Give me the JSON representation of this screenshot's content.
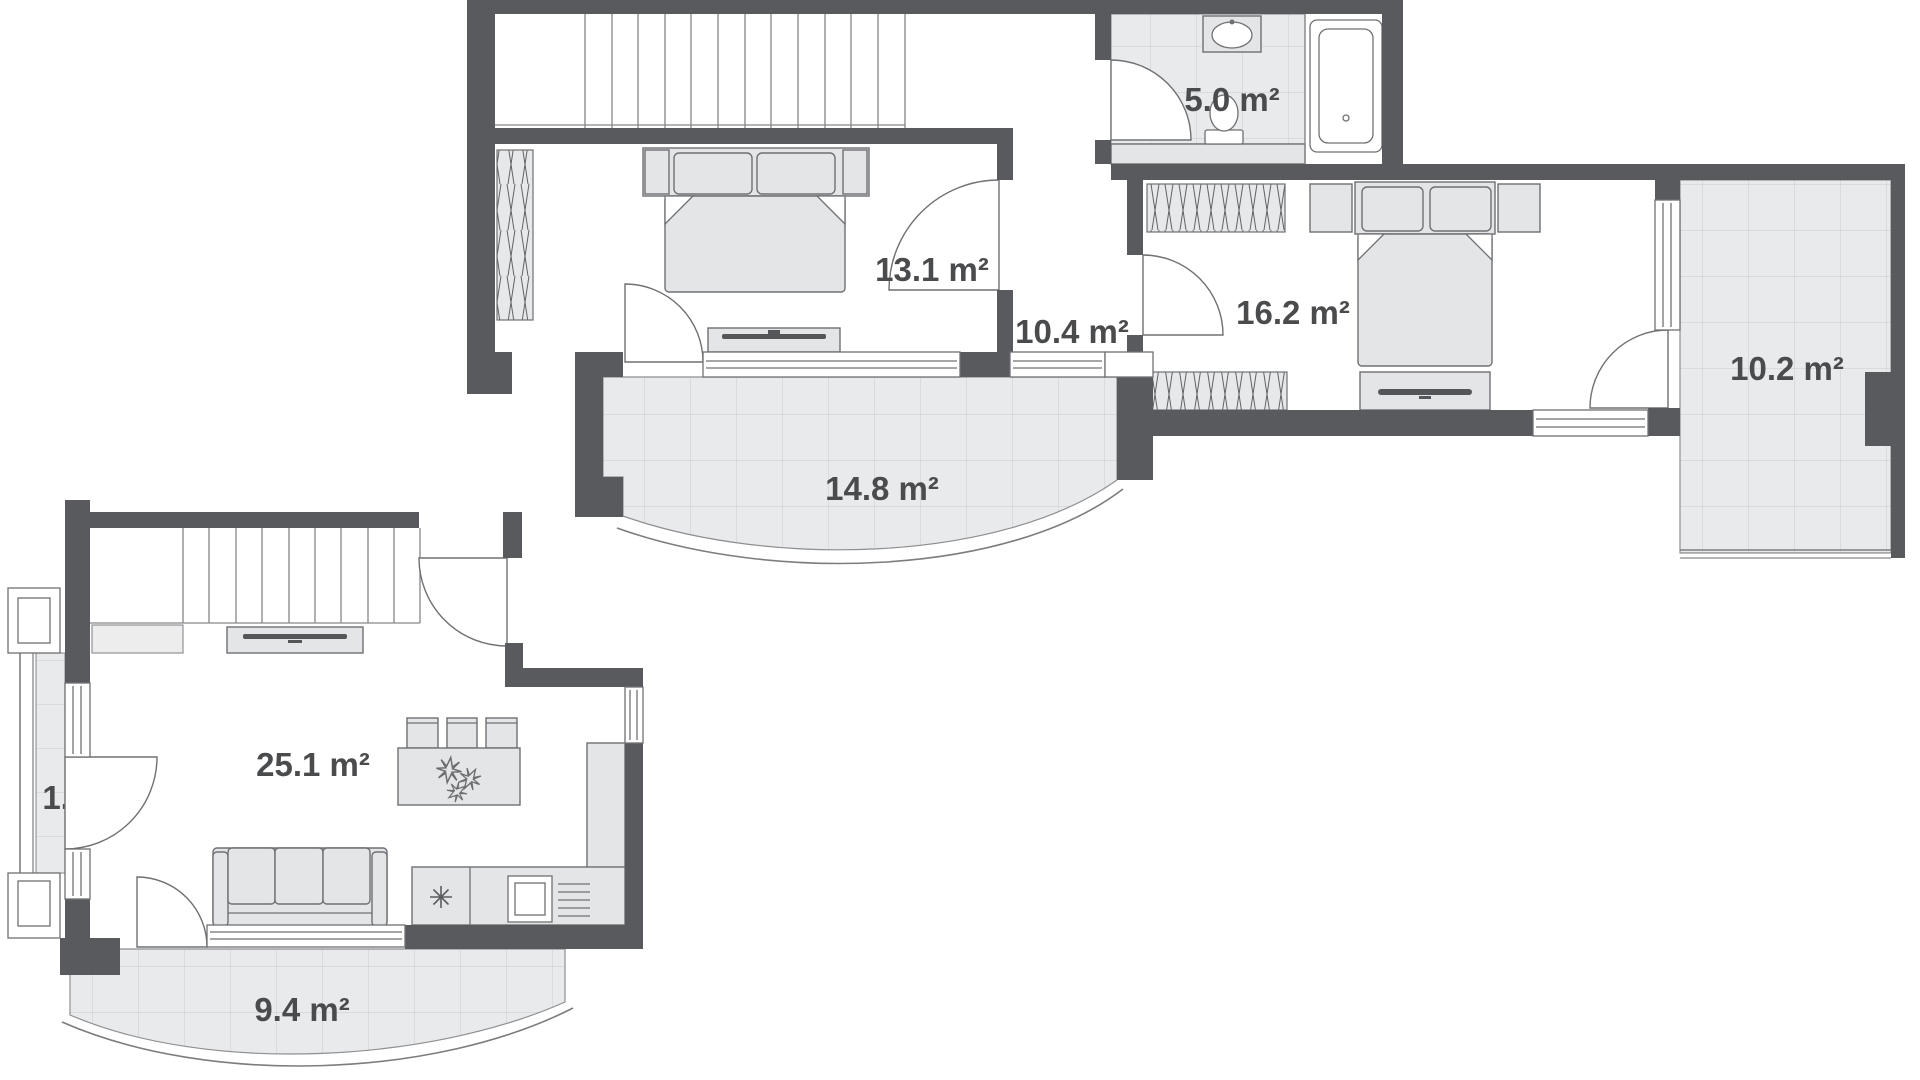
{
  "plan": {
    "type": "apartment-floor-plan",
    "background": "#ffffff",
    "colors": {
      "wall": "#595a5d",
      "furniture_fill": "#e4e5e6",
      "tile_fill": "#e9eaeb",
      "tile_line": "#cbccce",
      "outline": "#6f7073",
      "label_text": "#4a4b4d"
    }
  },
  "rooms": {
    "bedroom_13": {
      "area": "13.1 m²"
    },
    "hallway": {
      "area": "10.4 m²"
    },
    "bathroom": {
      "area": "5.0 m²"
    },
    "bedroom_16": {
      "area": "16.2 m²"
    },
    "balcony_10": {
      "area": "10.2 m²"
    },
    "balcony_14": {
      "area": "14.8 m²"
    },
    "living_room": {
      "area": "25.1 m²"
    },
    "balcony_1": {
      "area": "1.3 m²"
    },
    "balcony_9": {
      "area": "9.4 m²"
    }
  },
  "icons": {
    "plant": "flower-star",
    "hob": "asterisk"
  }
}
